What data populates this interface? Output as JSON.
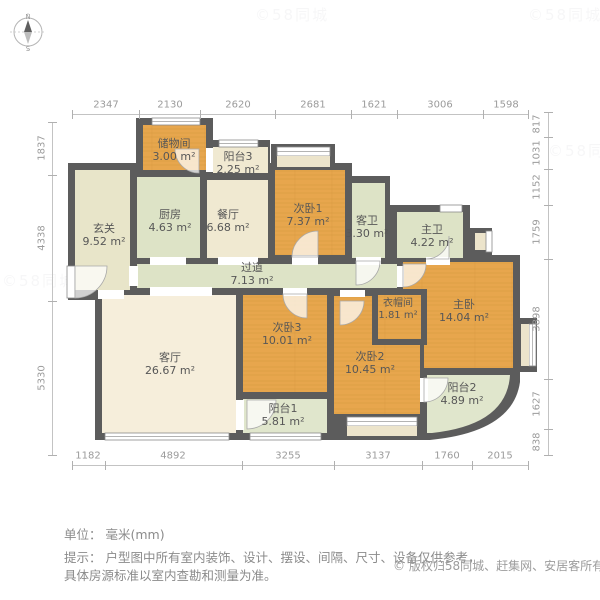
{
  "compass": {
    "north": "N",
    "south": "S"
  },
  "dimensions": {
    "top": [
      "2347",
      "2130",
      "2620",
      "2681",
      "1621",
      "3006",
      "1598"
    ],
    "bottom": [
      "1182",
      "4892",
      "3255",
      "3137",
      "1760",
      "2015"
    ],
    "left": [
      "1837",
      "4338",
      "5330"
    ],
    "right": [
      "817",
      "1031",
      "1152",
      "1759",
      "3898",
      "1627",
      "838"
    ]
  },
  "rooms": [
    {
      "name": "玄关",
      "area": "9.52 m²"
    },
    {
      "name": "储物间",
      "area": "3.00 m²"
    },
    {
      "name": "阳台3",
      "area": "2.25 m²"
    },
    {
      "name": "厨房",
      "area": "4.63 m²"
    },
    {
      "name": "餐厅",
      "area": "6.68 m²"
    },
    {
      "name": "次卧1",
      "area": "7.37 m²"
    },
    {
      "name": "客卫",
      "area": "3.30 m²"
    },
    {
      "name": "主卫",
      "area": "4.22 m²"
    },
    {
      "name": "过道",
      "area": "7.13 m²"
    },
    {
      "name": "客厅",
      "area": "26.67 m²"
    },
    {
      "name": "次卧3",
      "area": "10.01 m²"
    },
    {
      "name": "衣帽间",
      "area": "1.81 m²"
    },
    {
      "name": "主卧",
      "area": "14.04 m²"
    },
    {
      "name": "次卧2",
      "area": "10.45 m²"
    },
    {
      "name": "阳台1",
      "area": "5.81 m²"
    },
    {
      "name": "阳台2",
      "area": "4.89 m²"
    }
  ],
  "footer": {
    "unit_line": "单位： 毫米(mm)",
    "tip_line1": "提示： 户型图中所有室内装饰、设计、摆设、间隔、尺寸、设备仅供参考，",
    "tip_line2": "具体房源标准以室内查勘和测量为准。",
    "copyright_symbol": "©",
    "copyright": "版权归58同城、赶集网、安居客所有"
  },
  "watermark": {
    "text": "©58同城"
  },
  "colors": {
    "wall": "#5c5c5c",
    "wood": "#e7a64d",
    "green": "#dde3c6",
    "beige": "#f0e9d1",
    "cream": "#f6eedb",
    "balcony_green": "#e0e6cc",
    "dim_text": "#9b9b9b",
    "footer_text": "#8b8b8b"
  }
}
